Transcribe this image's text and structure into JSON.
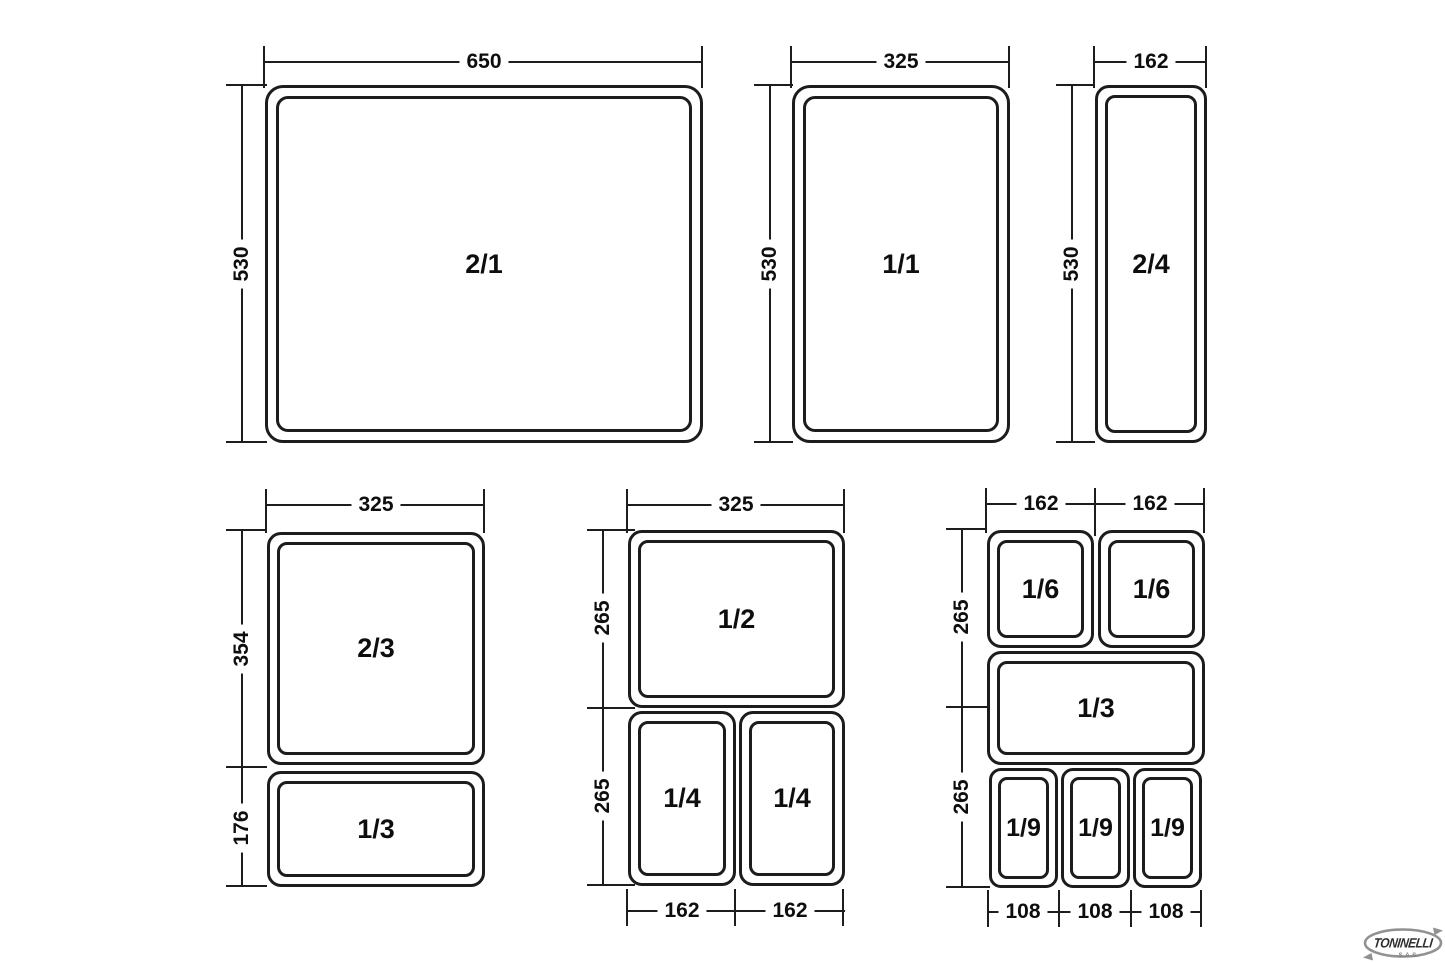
{
  "diagram": {
    "top_row": {
      "gn21": {
        "label": "2/1",
        "width": "650",
        "height": "530"
      },
      "gn11": {
        "label": "1/1",
        "width": "325",
        "height": "530"
      },
      "gn24": {
        "label": "2/4",
        "width": "162",
        "height": "530"
      }
    },
    "bottom_left": {
      "top_width": "325",
      "gn23": {
        "label": "2/3",
        "height": "354"
      },
      "gn13": {
        "label": "1/3",
        "height": "176"
      }
    },
    "bottom_middle": {
      "top_width": "325",
      "upper_height": "265",
      "lower_height": "265",
      "gn12": {
        "label": "1/2"
      },
      "gn14a": {
        "label": "1/4",
        "width": "162"
      },
      "gn14b": {
        "label": "1/4",
        "width": "162"
      }
    },
    "bottom_right": {
      "top_widths": [
        "162",
        "162"
      ],
      "left_heights": [
        "265",
        "265"
      ],
      "bottom_widths": [
        "108",
        "108",
        "108"
      ],
      "gn16a": {
        "label": "1/6"
      },
      "gn16b": {
        "label": "1/6"
      },
      "gn13": {
        "label": "1/3"
      },
      "gn19a": {
        "label": "1/9"
      },
      "gn19b": {
        "label": "1/9"
      },
      "gn19c": {
        "label": "1/9"
      }
    }
  },
  "logo": {
    "brand": "TONINELLI",
    "suffix": "S.A.S."
  }
}
